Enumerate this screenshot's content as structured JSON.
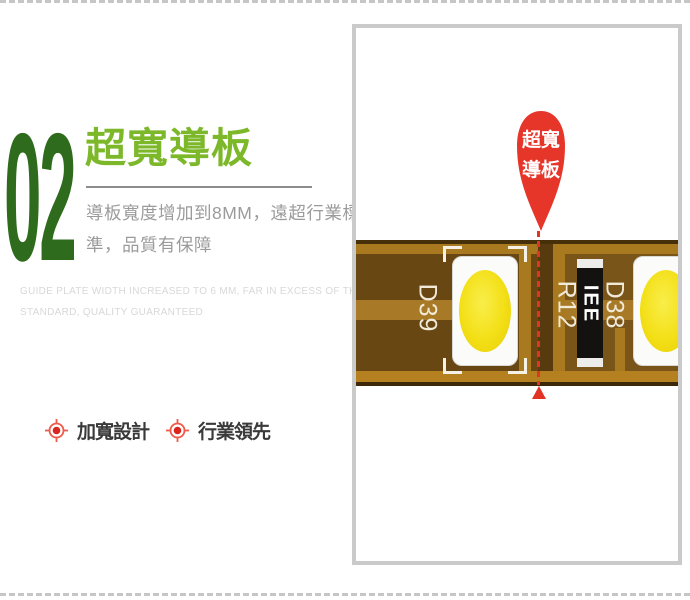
{
  "feature_section": {
    "number": "02",
    "title": "超寬導板",
    "description_lines": [
      "導板寬度增加到8MM，遠超行業標",
      "準，品質有保障"
    ],
    "description_en_lines": [
      "GUIDE PLATE WIDTH INCREASED TO 6 MM, FAR IN EXCESS OF THE INDUSTRY",
      "STANDARD, QUALITY GUARANTEED"
    ],
    "bullets": [
      {
        "icon": "target-icon",
        "label": "加寬設計"
      },
      {
        "icon": "target-icon",
        "label": "行業領先"
      }
    ]
  },
  "product_panel": {
    "callout_pin": {
      "line1": "超寬",
      "line2": "導板"
    },
    "pcb_labels": {
      "led_left": "D39",
      "resistor_ref": "R12",
      "resistor_marking": "IEE",
      "led_right": "D38"
    }
  },
  "colors": {
    "number_green": "#2f6b1c",
    "title_green": "#7cb82a",
    "description_gray": "#9b9b9b",
    "description_en_gray": "#d8d8d8",
    "bullet_text": "#3a3a3a",
    "accent_red": "#e6362a",
    "panel_border": "#cacaca",
    "pcb_body_brown": "#684712",
    "pcb_trace_gold": "#a9791f",
    "led_yellow": "#f3df16"
  }
}
